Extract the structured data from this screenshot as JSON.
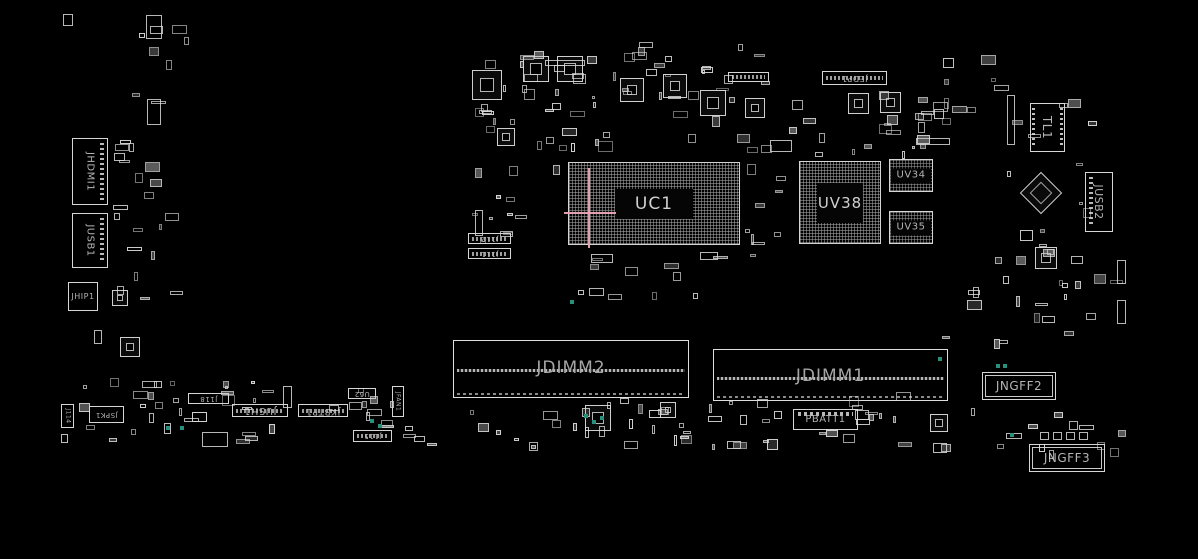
{
  "canvas": {
    "w": 1198,
    "h": 559,
    "bg": "#000000"
  },
  "palette": {
    "outline": "#d6d6d6",
    "label": "#b4b4b4",
    "bga_grid": "#a8a8a8",
    "highlight_pink": "#eda4b6",
    "via_teal": "#2a8f7c",
    "background": "#000000"
  },
  "components": [
    {
      "id": "jhdmi1",
      "label": "JHDMI1",
      "x": 72,
      "y": 138,
      "w": 36,
      "h": 67,
      "rot": 90,
      "fs": 10,
      "variant": "pins-right"
    },
    {
      "id": "jusb1",
      "label": "JUSB1",
      "x": 72,
      "y": 213,
      "w": 36,
      "h": 55,
      "rot": 90,
      "fs": 10,
      "variant": "pins-right"
    },
    {
      "id": "jhip1",
      "label": "JHIP1",
      "x": 68,
      "y": 282,
      "w": 30,
      "h": 29,
      "rot": 0,
      "fs": 8,
      "variant": "plain"
    },
    {
      "id": "j114",
      "label": "J114",
      "x": 61,
      "y": 404,
      "w": 13,
      "h": 24,
      "rot": 90,
      "fs": 6,
      "variant": "plain"
    },
    {
      "id": "jspk1",
      "label": "JSPK1",
      "x": 89,
      "y": 406,
      "w": 35,
      "h": 17,
      "rot": 180,
      "fs": 7,
      "variant": "plain"
    },
    {
      "id": "j118",
      "label": "J118",
      "x": 188,
      "y": 393,
      "w": 41,
      "h": 11,
      "rot": 180,
      "fs": 7,
      "variant": "plain"
    },
    {
      "id": "jush1",
      "label": "JUSH1",
      "x": 232,
      "y": 404,
      "w": 56,
      "h": 13,
      "rot": 180,
      "fs": 10,
      "variant": "pins-mid"
    },
    {
      "id": "jkbtp1",
      "label": "JKBTP1",
      "x": 298,
      "y": 404,
      "w": 50,
      "h": 13,
      "rot": 180,
      "fs": 9,
      "variant": "pins-mid"
    },
    {
      "id": "u62",
      "label": "U62",
      "x": 348,
      "y": 388,
      "w": 28,
      "h": 11,
      "rot": 180,
      "fs": 7,
      "variant": "plain"
    },
    {
      "id": "jfan1",
      "label": "JFAN1",
      "x": 392,
      "y": 386,
      "w": 12,
      "h": 31,
      "rot": 90,
      "fs": 6,
      "variant": "plain"
    },
    {
      "id": "j115",
      "label": "J115",
      "x": 353,
      "y": 430,
      "w": 39,
      "h": 12,
      "rot": 180,
      "fs": 7,
      "variant": "pins-mid"
    },
    {
      "id": "j112",
      "label": "J112",
      "x": 468,
      "y": 233,
      "w": 43,
      "h": 11,
      "rot": 180,
      "fs": 7,
      "variant": "pins-mid"
    },
    {
      "id": "j111",
      "label": "J111",
      "x": 468,
      "y": 248,
      "w": 43,
      "h": 11,
      "rot": 180,
      "fs": 7,
      "variant": "pins-mid"
    },
    {
      "id": "jedp1",
      "label": "JEDP1",
      "x": 822,
      "y": 71,
      "w": 65,
      "h": 14,
      "rot": 180,
      "fs": 8,
      "variant": "pins-mid"
    },
    {
      "id": "j-small-header",
      "label": "",
      "x": 728,
      "y": 72,
      "w": 41,
      "h": 10,
      "rot": 180,
      "fs": 6,
      "variant": "pins-mid"
    },
    {
      "id": "tl1",
      "label": "TL1",
      "x": 1030,
      "y": 103,
      "w": 35,
      "h": 49,
      "rot": 90,
      "fs": 12,
      "variant": "pins-sides"
    },
    {
      "id": "jusb2",
      "label": "JUSB2",
      "x": 1085,
      "y": 172,
      "w": 28,
      "h": 60,
      "rot": 90,
      "fs": 11,
      "variant": "pins-left"
    },
    {
      "id": "uv34",
      "label": "UV34",
      "x": 889,
      "y": 159,
      "w": 44,
      "h": 33,
      "rot": 0,
      "fs": 10,
      "variant": "mem"
    },
    {
      "id": "uv35",
      "label": "UV35",
      "x": 889,
      "y": 211,
      "w": 44,
      "h": 33,
      "rot": 0,
      "fs": 10,
      "variant": "mem"
    },
    {
      "id": "pbatt1",
      "label": "PBATT1",
      "x": 793,
      "y": 409,
      "w": 65,
      "h": 21,
      "rot": 0,
      "fs": 10,
      "variant": "pins-top"
    },
    {
      "id": "jngff2",
      "label": "JNGFF2",
      "x": 982,
      "y": 372,
      "w": 74,
      "h": 28,
      "rot": 0,
      "fs": 12,
      "variant": "double"
    },
    {
      "id": "jngff3",
      "label": "JNGFF3",
      "x": 1029,
      "y": 444,
      "w": 76,
      "h": 28,
      "rot": 0,
      "fs": 12,
      "variant": "double"
    }
  ],
  "bgas": [
    {
      "id": "uc1",
      "label": "UC1",
      "x": 568,
      "y": 162,
      "w": 172,
      "h": 83,
      "fs": 17,
      "inner_w": 78,
      "inner_h": 30
    },
    {
      "id": "uv38",
      "label": "UV38",
      "x": 799,
      "y": 161,
      "w": 82,
      "h": 83,
      "fs": 15,
      "inner_w": 46,
      "inner_h": 40
    }
  ],
  "dimms": [
    {
      "id": "jdimm2",
      "label": "JDIMM2",
      "x": 453,
      "y": 340,
      "w": 236,
      "h": 58,
      "line_y": 28,
      "fs": 17
    },
    {
      "id": "jdimm1",
      "label": "JDIMM1",
      "x": 713,
      "y": 349,
      "w": 235,
      "h": 52,
      "line_y": 27,
      "fs": 17
    }
  ],
  "crosshair": {
    "vx": 588,
    "vy1": 168,
    "vy2": 248,
    "hy": 212,
    "hx1": 564,
    "hx2": 616
  },
  "qfns": [
    [
      472,
      70,
      30
    ],
    [
      523,
      56,
      26
    ],
    [
      557,
      56,
      26
    ],
    [
      620,
      78,
      24
    ],
    [
      663,
      74,
      24
    ],
    [
      700,
      90,
      26
    ],
    [
      745,
      98,
      20
    ],
    [
      848,
      93,
      21
    ],
    [
      880,
      92,
      21
    ],
    [
      497,
      128,
      18
    ],
    [
      585,
      405,
      26
    ],
    [
      660,
      402,
      16
    ],
    [
      930,
      414,
      18
    ],
    [
      112,
      290,
      16
    ],
    [
      120,
      337,
      20
    ],
    [
      1035,
      247,
      22
    ]
  ],
  "misc_parts": [
    [
      1007,
      95,
      8,
      50
    ],
    [
      1040,
      432,
      9,
      8
    ],
    [
      1053,
      432,
      9,
      8
    ],
    [
      1066,
      432,
      9,
      8
    ],
    [
      1079,
      432,
      9,
      8
    ],
    [
      1006,
      433,
      16,
      6
    ],
    [
      283,
      386,
      9,
      22
    ],
    [
      202,
      432,
      26,
      15
    ],
    [
      147,
      99,
      14,
      26
    ],
    [
      94,
      330,
      8,
      14
    ],
    [
      63,
      14,
      10,
      12
    ],
    [
      146,
      15,
      16,
      24
    ],
    [
      770,
      140,
      22,
      12
    ],
    [
      545,
      60,
      40,
      6
    ],
    [
      916,
      138,
      34,
      7
    ],
    [
      591,
      254,
      22,
      9
    ],
    [
      700,
      252,
      18,
      8
    ],
    [
      475,
      210,
      8,
      26
    ],
    [
      1117,
      260,
      9,
      24
    ],
    [
      1117,
      300,
      9,
      24
    ]
  ],
  "diamond": {
    "x": 1026,
    "y": 178,
    "size": 30
  },
  "teal_dots": [
    [
      166,
      426
    ],
    [
      180,
      426
    ],
    [
      370,
      419
    ],
    [
      378,
      424
    ],
    [
      584,
      414
    ],
    [
      592,
      420
    ],
    [
      600,
      416
    ],
    [
      996,
      364
    ],
    [
      1003,
      364
    ],
    [
      1010,
      433
    ],
    [
      938,
      357
    ],
    [
      570,
      300
    ]
  ],
  "scatter_regions": [
    {
      "x": 462,
      "y": 42,
      "w": 158,
      "h": 112,
      "n": 26,
      "seed": 11
    },
    {
      "x": 622,
      "y": 42,
      "w": 155,
      "h": 112,
      "n": 26,
      "seed": 22
    },
    {
      "x": 782,
      "y": 90,
      "w": 168,
      "h": 70,
      "n": 22,
      "seed": 33
    },
    {
      "x": 915,
      "y": 55,
      "w": 95,
      "h": 75,
      "n": 10,
      "seed": 44
    },
    {
      "x": 1000,
      "y": 90,
      "w": 126,
      "h": 168,
      "n": 14,
      "seed": 55
    },
    {
      "x": 470,
      "y": 118,
      "w": 92,
      "h": 138,
      "n": 16,
      "seed": 66
    },
    {
      "x": 745,
      "y": 132,
      "w": 52,
      "h": 124,
      "n": 10,
      "seed": 77
    },
    {
      "x": 545,
      "y": 250,
      "w": 215,
      "h": 56,
      "n": 12,
      "seed": 88
    },
    {
      "x": 935,
      "y": 240,
      "w": 190,
      "h": 116,
      "n": 22,
      "seed": 99
    },
    {
      "x": 108,
      "y": 133,
      "w": 84,
      "h": 194,
      "n": 20,
      "seed": 101
    },
    {
      "x": 112,
      "y": 15,
      "w": 78,
      "h": 110,
      "n": 8,
      "seed": 112
    },
    {
      "x": 60,
      "y": 376,
      "w": 340,
      "h": 70,
      "n": 42,
      "seed": 123
    },
    {
      "x": 400,
      "y": 398,
      "w": 400,
      "h": 54,
      "n": 42,
      "seed": 134
    },
    {
      "x": 815,
      "y": 390,
      "w": 165,
      "h": 64,
      "n": 16,
      "seed": 145
    },
    {
      "x": 985,
      "y": 404,
      "w": 143,
      "h": 56,
      "n": 10,
      "seed": 156
    },
    {
      "x": 548,
      "y": 138,
      "w": 200,
      "h": 16,
      "n": 4,
      "seed": 167
    }
  ]
}
